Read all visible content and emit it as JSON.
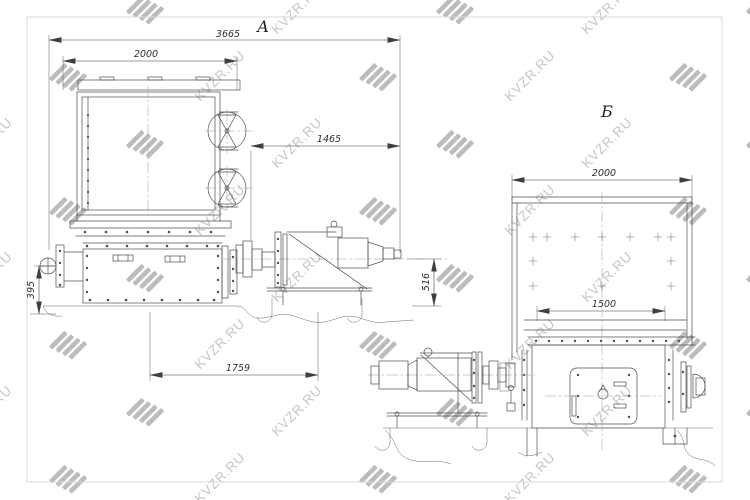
{
  "watermark": {
    "text": "KVZR.RU",
    "text_color": "#c6c6c6",
    "logo_color": "#bcbcbc"
  },
  "drawing": {
    "frame_color": "#d9d9d9",
    "line_color": "#4f4f4f",
    "view_a": {
      "label": "А",
      "dim_overall_width": "3665",
      "dim_hopper_width": "2000",
      "dim_drive_span": "1465",
      "dim_axis_height": "516",
      "dim_flange_height": "395",
      "dim_base_span": "1759"
    },
    "view_b": {
      "label": "Б",
      "dim_hopper_width": "2000",
      "dim_chute_width": "1500"
    }
  }
}
